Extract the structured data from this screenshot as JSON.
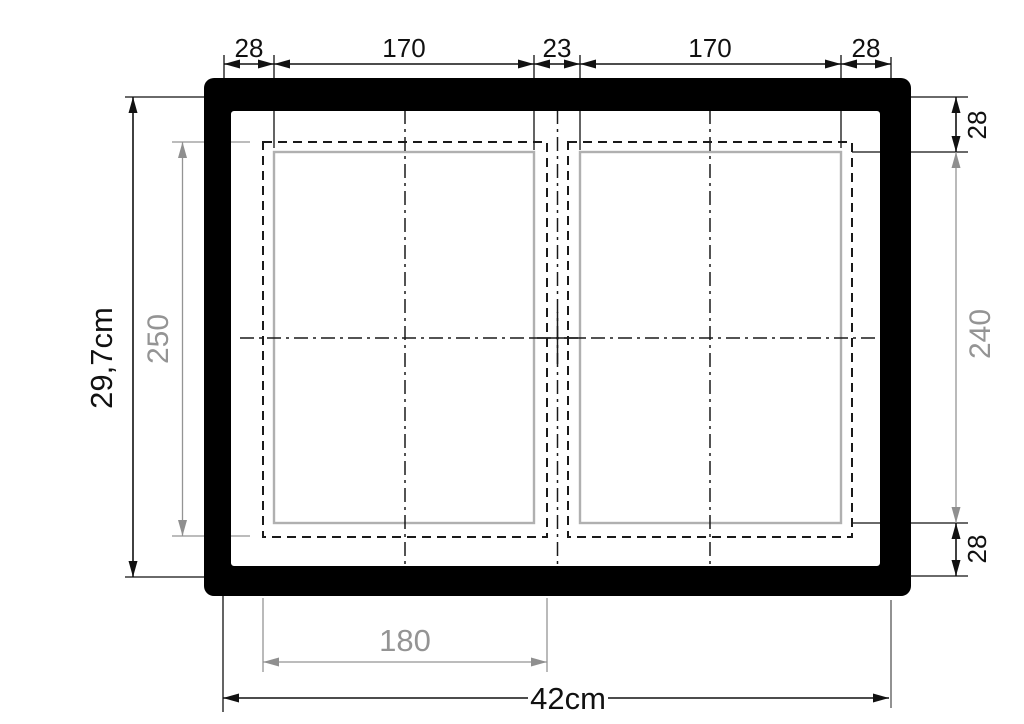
{
  "drawing": {
    "kind": "frame-technical-drawing",
    "dimensions": {
      "top": [
        "28",
        "170",
        "23",
        "170",
        "28"
      ],
      "outer_height": "29,7cm",
      "inner_height_left": "250",
      "right_top_inset": "28",
      "inner_height_right": "240",
      "right_bottom_inset": "28",
      "inner_width_bottom": "180",
      "outer_width": "42cm"
    },
    "colors": {
      "ink": "#111111",
      "dim_gray": "#949494",
      "panel_gray": "#b0b0b0",
      "background": "#ffffff"
    }
  }
}
